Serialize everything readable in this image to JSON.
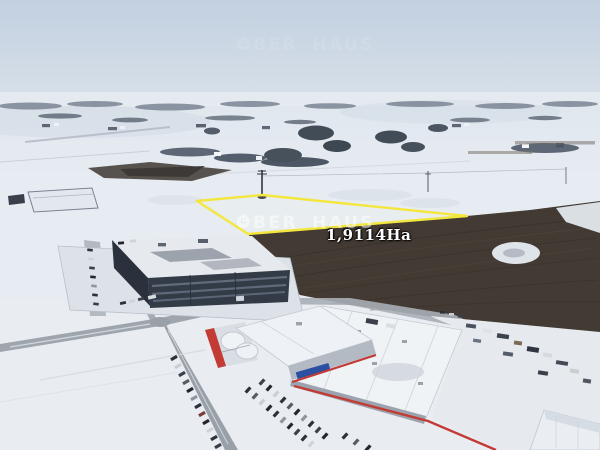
{
  "annotation": {
    "area_label": "1,9114Ha",
    "plot_outline_color": "#f3e73e"
  },
  "watermark": {
    "left": "OBER",
    "right": "HAUS",
    "color": "#ffffff"
  },
  "palette": {
    "sky": "#c6d3e2",
    "snow": "#e7ecf2",
    "dark_field": "#433b33",
    "dark_building_facade": "#333b47",
    "warehouse_roof": "#f0f3f5",
    "accent_red": "#c23b35",
    "sign_blue": "#2b4fa3",
    "road_gray": "#9aa0a8",
    "trees": "#44505a"
  }
}
